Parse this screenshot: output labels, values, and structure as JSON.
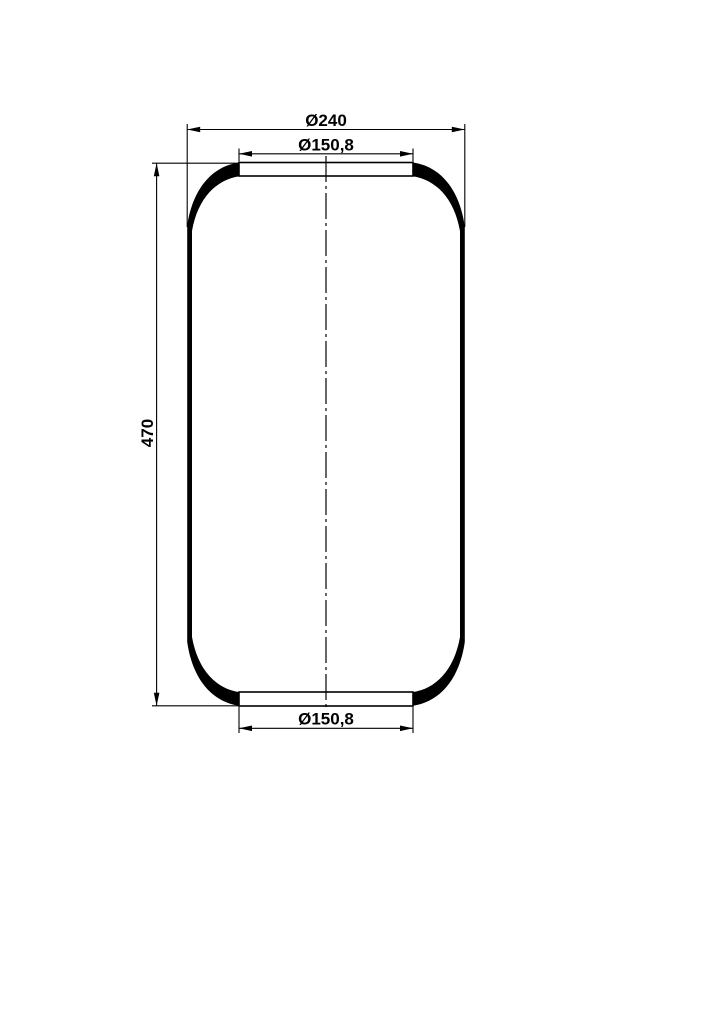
{
  "page": {
    "background_color": "#ffffff",
    "line_color": "#000000"
  },
  "drawing": {
    "description": "Technical sectional drawing of a cylindrical rubber air spring bellows with centerline and dimension annotations",
    "dimensions": {
      "outer_diameter_label": "Ø240",
      "top_opening_diameter_label": "Ø150,8",
      "height_label": "470",
      "bottom_opening_diameter_label": "Ø150,8"
    }
  }
}
